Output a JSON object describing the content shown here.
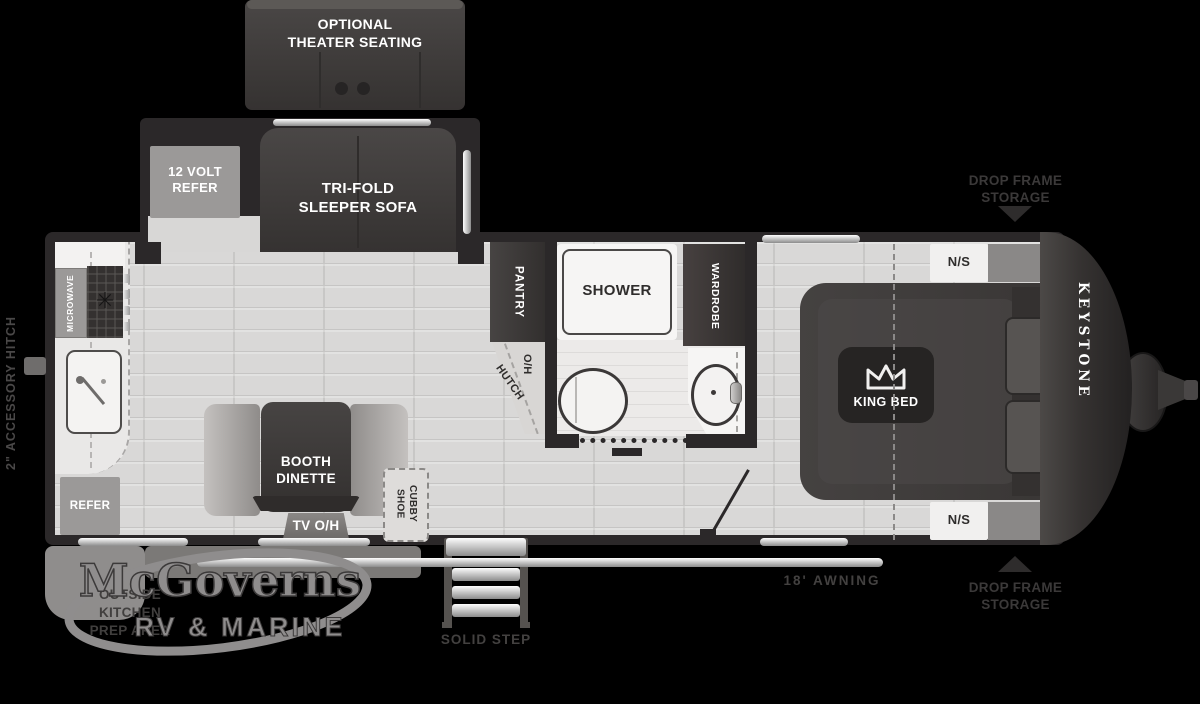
{
  "brand": {
    "model_label": "KEYSTONE"
  },
  "dealer": {
    "name": "McGoverns",
    "tagline": "RV & MARINE"
  },
  "rooms": {
    "theater": "OPTIONAL\nTHEATER SEATING",
    "refer_12v": "12 VOLT\nREFER",
    "sofa": "TRI-FOLD\nSLEEPER SOFA",
    "microwave": "MICROWAVE",
    "pantry": "PANTRY",
    "hutch_oh": "O/H",
    "hutch": "HUTCH",
    "shower": "SHOWER",
    "wardrobe": "WARDROBE",
    "booth": "BOOTH\nDINETTE",
    "tv": "TV O/H",
    "shoe_cubby": "SHOE\nCUBBY",
    "refer": "REFER",
    "king_bed": "KING BED",
    "nightstand_front": "N/S",
    "nightstand_rear": "N/S"
  },
  "exterior": {
    "hitch": "2\" ACCESSORY HITCH",
    "drop_frame_front": "DROP FRAME\nSTORAGE",
    "drop_frame_rear": "DROP FRAME\nSTORAGE",
    "awning": "18'  AWNING",
    "step": "SOLID STEP",
    "outside_kitchen": "OUTSIDE\nKITCHEN\nPREP AREA"
  },
  "colors": {
    "background": "#000000",
    "wall": "#2b2829",
    "floor": "#d9d8d7",
    "dark_furniture": "#3f3c3b",
    "light_fixture": "#f2f1f0",
    "gray_appliance": "#9b9998",
    "silver_trim": "#c9c9c9",
    "exterior_label": "#434140",
    "logo_gray": "#8f8d8d"
  }
}
